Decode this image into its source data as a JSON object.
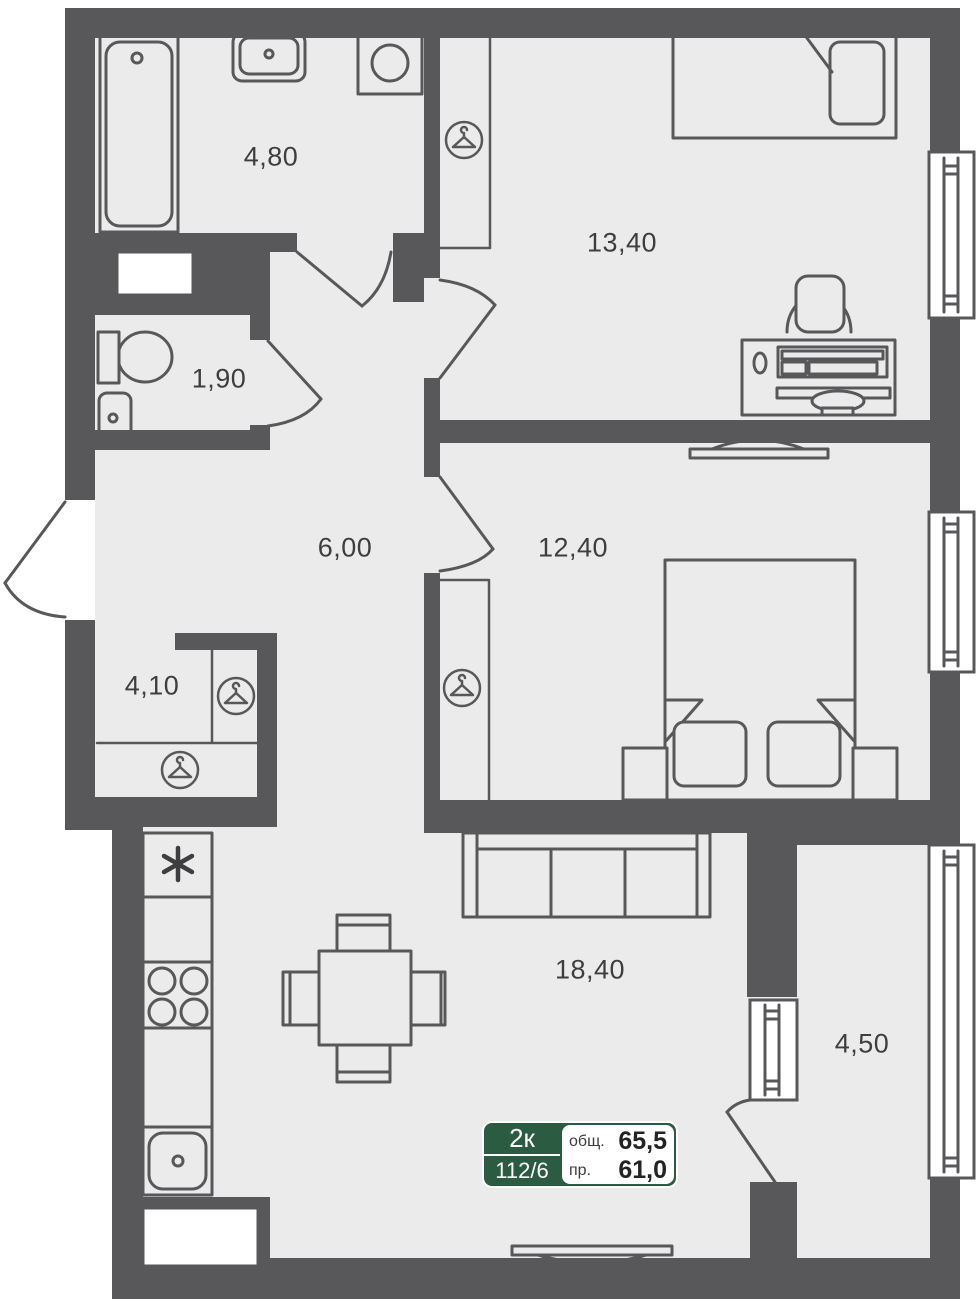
{
  "rooms": [
    {
      "name": "bathroom",
      "area": "4,80"
    },
    {
      "name": "bedroom-1",
      "area": "13,40"
    },
    {
      "name": "wc",
      "area": "1,90"
    },
    {
      "name": "hallway",
      "area": "6,00"
    },
    {
      "name": "bedroom-2",
      "area": "12,40"
    },
    {
      "name": "wardrobe",
      "area": "4,10"
    },
    {
      "name": "living-kitchen",
      "area": "18,40"
    },
    {
      "name": "balcony",
      "area": "4,50"
    }
  ],
  "unit_card": {
    "rooms_label": "2к",
    "unit_number": "112/6",
    "total_area_label": "общ.",
    "total_area_value": "65,5",
    "living_area_label": "пр.",
    "living_area_value": "61,0"
  },
  "colors": {
    "wall": "#58585a",
    "floor": "#ebebeb",
    "badge_green": "#2b5c42",
    "label_text": "#3e3e40"
  }
}
